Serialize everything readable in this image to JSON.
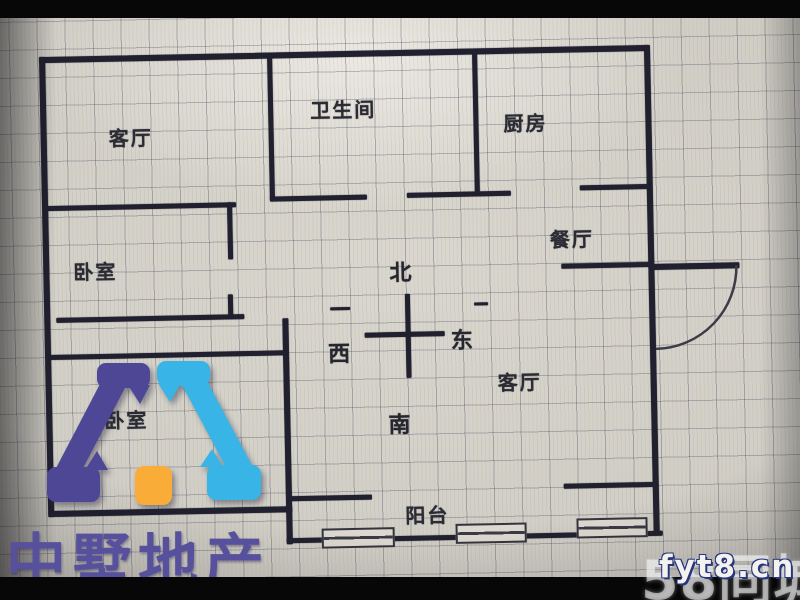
{
  "photo": {
    "kind": "floor-plan-listing-photo"
  },
  "rooms": [
    {
      "id": "living-top",
      "label": "客厅",
      "x": 112,
      "y": 117
    },
    {
      "id": "bathroom",
      "label": "卫生间",
      "x": 314,
      "y": 93
    },
    {
      "id": "kitchen",
      "label": "厨房",
      "x": 507,
      "y": 110
    },
    {
      "id": "dining",
      "label": "餐厅",
      "x": 551,
      "y": 227
    },
    {
      "id": "bedroom-1",
      "label": "卧室",
      "x": 74,
      "y": 250
    },
    {
      "id": "bedroom-2",
      "label": "卧室",
      "x": 102,
      "y": 399
    },
    {
      "id": "living-main",
      "label": "客厅",
      "x": 496,
      "y": 369
    },
    {
      "id": "balcony",
      "label": "阳台",
      "x": 401,
      "y": 500
    }
  ],
  "compass": {
    "north": "北",
    "south": "南",
    "east": "东",
    "west": "西",
    "north_pos": {
      "x": 390,
      "y": 255
    },
    "south_pos": {
      "x": 386,
      "y": 407
    },
    "east_pos": {
      "x": 450,
      "y": 324
    },
    "west_pos": {
      "x": 327,
      "y": 335
    },
    "cross": [
      {
        "x": 364,
        "y": 332,
        "w": 80,
        "h": 5
      },
      {
        "x": 405,
        "y": 294,
        "w": 5,
        "h": 84
      }
    ]
  },
  "walls": [
    {
      "x": 44,
      "y": 50,
      "w": 610,
      "h": 6
    },
    {
      "x": 44,
      "y": 50,
      "w": 6,
      "h": 460
    },
    {
      "x": 46,
      "y": 504,
      "w": 242,
      "h": 6
    },
    {
      "x": 282,
      "y": 316,
      "w": 6,
      "h": 226
    },
    {
      "x": 282,
      "y": 536,
      "w": 376,
      "h": 5
    },
    {
      "x": 649,
      "y": 50,
      "w": 6,
      "h": 488
    },
    {
      "x": 651,
      "y": 269,
      "w": 89,
      "h": 6
    },
    {
      "x": 272,
      "y": 52,
      "w": 5,
      "h": 146
    },
    {
      "x": 272,
      "y": 194,
      "w": 97,
      "h": 5
    },
    {
      "x": 409,
      "y": 193,
      "w": 104,
      "h": 5
    },
    {
      "x": 477,
      "y": 52,
      "w": 5,
      "h": 143
    },
    {
      "x": 582,
      "y": 189,
      "w": 70,
      "h": 5
    },
    {
      "x": 562,
      "y": 267,
      "w": 90,
      "h": 5
    },
    {
      "x": 46,
      "y": 199,
      "w": 192,
      "h": 5
    },
    {
      "x": 229,
      "y": 199,
      "w": 5,
      "h": 57
    },
    {
      "x": 56,
      "y": 311,
      "w": 188,
      "h": 5
    },
    {
      "x": 228,
      "y": 291,
      "w": 5,
      "h": 23
    },
    {
      "x": 48,
      "y": 348,
      "w": 238,
      "h": 5
    },
    {
      "x": 285,
      "y": 494,
      "w": 83,
      "h": 5
    },
    {
      "x": 560,
      "y": 487,
      "w": 93,
      "h": 5
    },
    {
      "x": 330,
      "y": 306,
      "w": 20,
      "h": 3
    },
    {
      "x": 474,
      "y": 304,
      "w": 14,
      "h": 3
    }
  ],
  "windows": [
    {
      "x": 317,
      "y": 527,
      "w": 73,
      "h": 20
    },
    {
      "x": 451,
      "y": 525,
      "w": 71,
      "h": 20
    },
    {
      "x": 572,
      "y": 522,
      "w": 71,
      "h": 20
    }
  ],
  "door": {
    "arc_path": "M 737,272 A 82 82 0 0 1 655,354"
  },
  "logo": {
    "text": "中墅地产",
    "colors": {
      "indigo": "#4d4796",
      "cyan": "#38b4e6",
      "orange": "#f9ac38",
      "text": "#57509c"
    }
  },
  "watermarks": {
    "brand": "58同城",
    "site": "fyt8.cn"
  }
}
